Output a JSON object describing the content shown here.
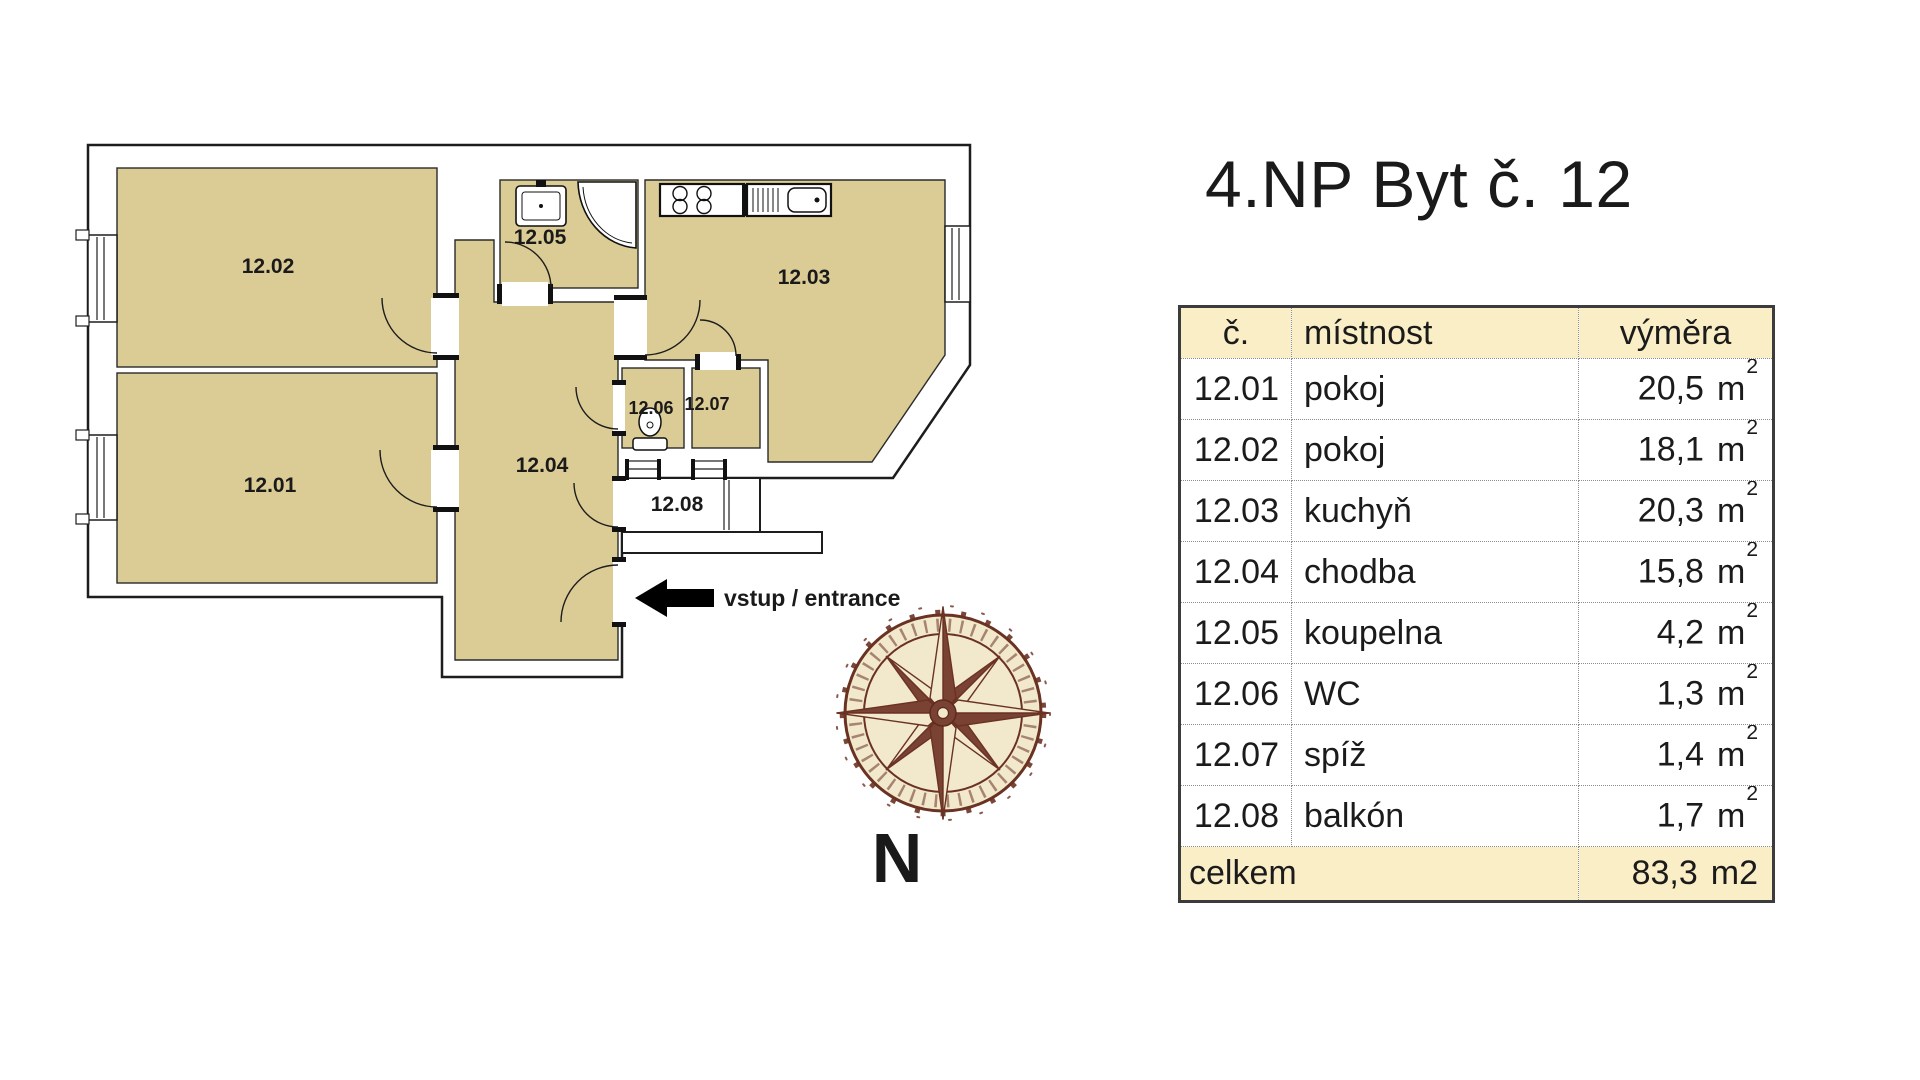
{
  "title": "4.NP Byt č. 12",
  "plan": {
    "room_labels": [
      "12.01",
      "12.02",
      "12.03",
      "12.04",
      "12.05",
      "12.06",
      "12.07",
      "12.08"
    ],
    "entrance_label": "vstup / entrance",
    "north_label": "N"
  },
  "table": {
    "headers": {
      "number": "č.",
      "room": "místnost",
      "area": "výměra"
    },
    "rows": [
      {
        "number": "12.01",
        "room": "pokoj",
        "area": "20,5",
        "unit": "m",
        "exp": "2"
      },
      {
        "number": "12.02",
        "room": "pokoj",
        "area": "18,1",
        "unit": "m",
        "exp": "2"
      },
      {
        "number": "12.03",
        "room": "kuchyň",
        "area": "20,3",
        "unit": "m",
        "exp": "2"
      },
      {
        "number": "12.04",
        "room": "chodba",
        "area": "15,8",
        "unit": "m",
        "exp": "2"
      },
      {
        "number": "12.05",
        "room": "koupelna",
        "area": "4,2",
        "unit": "m",
        "exp": "2"
      },
      {
        "number": "12.06",
        "room": "WC",
        "area": "1,3",
        "unit": "m",
        "exp": "2"
      },
      {
        "number": "12.07",
        "room": "spíž",
        "area": "1,4",
        "unit": "m",
        "exp": "2"
      },
      {
        "number": "12.08",
        "room": "balkón",
        "area": "1,7",
        "unit": "m",
        "exp": "2"
      }
    ],
    "total": {
      "label": "celkem",
      "area": "83,3",
      "unit": "m2"
    }
  },
  "colors": {
    "room_fill": "#dbcc95",
    "wall_stroke": "#1d1d1d",
    "table_header_bg": "#faeec6",
    "compass_brown": "#6a3222",
    "compass_cream": "#f2e9cd"
  }
}
